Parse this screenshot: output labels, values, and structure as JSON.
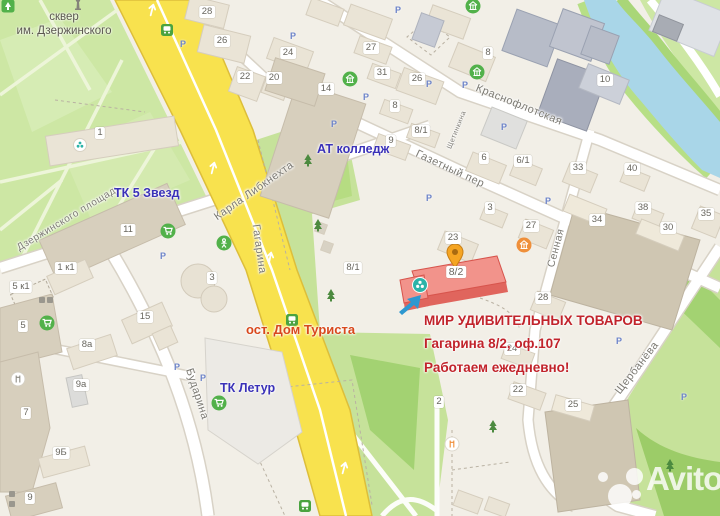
{
  "map_title": "Карта проезда",
  "colors": {
    "road-yellow": "#f8e24e",
    "road-yellow-edge": "#ddbe3a",
    "park-green": "#cde7a4",
    "strip-green": "#c6e29a",
    "dark-green": "#a3d272",
    "river-blue": "#a9d6e8",
    "building-beige": "#eae4d6",
    "building-dark": "#d7cfbd",
    "highlight-red": "#f2938b",
    "highlight-red-side": "#e0655d",
    "label-blue": "#3a31b8",
    "label-red": "#c1232b",
    "label-orange-red": "#d8481c",
    "street-grey": "#7c7a73",
    "poi-green": "#52b14a",
    "pin-orange": "#f5a523",
    "arrow-blue": "#2e98d0",
    "teal": "#2cb3a8"
  },
  "park_label": {
    "line1": "сквер",
    "line2": "им. Дзержинского"
  },
  "annotations": {
    "tk5": "ТК 5 Звезд",
    "at_college": "АТ колледж",
    "tk_letur": "ТК Летур",
    "bus_stop": "ост. Дом Туриста",
    "mir_line1": "МИР УДИВИТЕЛЬНЫХ ТОВАРОВ",
    "mir_line2": "Гагарина 8/2, оф.107",
    "mir_line3": "Работаем ежедневно!"
  },
  "highlight": {
    "number": "8/2"
  },
  "parking_label": "Р",
  "watermark": {
    "text": "Avito"
  },
  "streets": [
    {
      "name": "Дзержинского площадь",
      "x": 69,
      "y": 218,
      "rot": -31,
      "size": 10
    },
    {
      "name": "Карла Либкнехта",
      "x": 254,
      "y": 191,
      "rot": -35,
      "size": 11
    },
    {
      "name": "Гагарина",
      "x": 259,
      "y": 249,
      "rot": 82,
      "size": 11
    },
    {
      "name": "Краснофлотская",
      "x": 519,
      "y": 105,
      "rot": 22,
      "size": 11
    },
    {
      "name": "Газетный пер",
      "x": 450,
      "y": 169,
      "rot": 25,
      "size": 11
    },
    {
      "name": "Щетинкина",
      "x": 457,
      "y": 130,
      "rot": -68,
      "size": 7
    },
    {
      "name": "Сенная",
      "x": 556,
      "y": 248,
      "rot": -75,
      "size": 10.5
    },
    {
      "name": "Щербанёва",
      "x": 637,
      "y": 368,
      "rot": -52,
      "size": 11
    },
    {
      "name": "Бударина",
      "x": 197,
      "y": 394,
      "rot": 72,
      "size": 11
    }
  ],
  "building_numbers": [
    {
      "label": "28",
      "x": 207,
      "y": 12
    },
    {
      "label": "26",
      "x": 222,
      "y": 41
    },
    {
      "label": "24",
      "x": 288,
      "y": 53
    },
    {
      "label": "22",
      "x": 245,
      "y": 77
    },
    {
      "label": "20",
      "x": 274,
      "y": 78
    },
    {
      "label": "14",
      "x": 326,
      "y": 89
    },
    {
      "label": "27",
      "x": 371,
      "y": 48
    },
    {
      "label": "31",
      "x": 382,
      "y": 73
    },
    {
      "label": "26",
      "x": 417,
      "y": 79
    },
    {
      "label": "8",
      "x": 395,
      "y": 106
    },
    {
      "label": "8/1",
      "x": 421,
      "y": 131
    },
    {
      "label": "9",
      "x": 391,
      "y": 141
    },
    {
      "label": "8",
      "x": 488,
      "y": 53
    },
    {
      "label": "10",
      "x": 605,
      "y": 80
    },
    {
      "label": "6",
      "x": 484,
      "y": 158
    },
    {
      "label": "6/1",
      "x": 523,
      "y": 161
    },
    {
      "label": "33",
      "x": 578,
      "y": 168
    },
    {
      "label": "40",
      "x": 632,
      "y": 169
    },
    {
      "label": "38",
      "x": 643,
      "y": 208
    },
    {
      "label": "34",
      "x": 597,
      "y": 220
    },
    {
      "label": "30",
      "x": 668,
      "y": 228
    },
    {
      "label": "35",
      "x": 706,
      "y": 214
    },
    {
      "label": "3",
      "x": 490,
      "y": 208
    },
    {
      "label": "27",
      "x": 531,
      "y": 226
    },
    {
      "label": "23",
      "x": 453,
      "y": 238
    },
    {
      "label": "28",
      "x": 543,
      "y": 298
    },
    {
      "label": "24",
      "x": 512,
      "y": 349
    },
    {
      "label": "22",
      "x": 518,
      "y": 390
    },
    {
      "label": "25",
      "x": 573,
      "y": 405
    },
    {
      "label": "1",
      "x": 100,
      "y": 133
    },
    {
      "label": "11",
      "x": 128,
      "y": 230
    },
    {
      "label": "1 к1",
      "x": 66,
      "y": 268
    },
    {
      "label": "5 к1",
      "x": 21,
      "y": 287
    },
    {
      "label": "5",
      "x": 23,
      "y": 326
    },
    {
      "label": "3",
      "x": 212,
      "y": 278
    },
    {
      "label": "15",
      "x": 145,
      "y": 317
    },
    {
      "label": "8а",
      "x": 87,
      "y": 345
    },
    {
      "label": "9а",
      "x": 81,
      "y": 385
    },
    {
      "label": "7",
      "x": 26,
      "y": 413
    },
    {
      "label": "9Б",
      "x": 61,
      "y": 453
    },
    {
      "label": "9",
      "x": 30,
      "y": 498
    },
    {
      "label": "8/1",
      "x": 353,
      "y": 268
    },
    {
      "label": "2",
      "x": 439,
      "y": 402
    },
    {
      "label": "8/2",
      "x": 456,
      "y": 272
    }
  ],
  "parking_markers": [
    {
      "x": 398,
      "y": 10
    },
    {
      "x": 293,
      "y": 36
    },
    {
      "x": 366,
      "y": 97
    },
    {
      "x": 334,
      "y": 124
    },
    {
      "x": 429,
      "y": 84
    },
    {
      "x": 465,
      "y": 85
    },
    {
      "x": 429,
      "y": 198
    },
    {
      "x": 548,
      "y": 201
    },
    {
      "x": 504,
      "y": 127
    },
    {
      "x": 177,
      "y": 367
    },
    {
      "x": 203,
      "y": 378
    },
    {
      "x": 684,
      "y": 397
    },
    {
      "x": 619,
      "y": 341
    },
    {
      "x": 183,
      "y": 44
    },
    {
      "x": 163,
      "y": 256
    }
  ],
  "pois": [
    {
      "type": "pin",
      "x": 455,
      "y": 256,
      "name": "listing-pin"
    },
    {
      "type": "arrow",
      "x": 412,
      "y": 303,
      "name": "pointer-arrow"
    },
    {
      "type": "swirl",
      "x": 420,
      "y": 285,
      "name": "company-logo-marker"
    },
    {
      "type": "cart",
      "x": 168,
      "y": 231,
      "name": "supermarket"
    },
    {
      "type": "cart",
      "x": 47,
      "y": 323,
      "name": "supermarket"
    },
    {
      "type": "cart",
      "x": 219,
      "y": 403,
      "name": "supermarket"
    },
    {
      "type": "bus",
      "x": 167,
      "y": 30,
      "name": "bus-stop"
    },
    {
      "type": "bus",
      "x": 292,
      "y": 320,
      "name": "bus-stop"
    },
    {
      "type": "bus",
      "x": 305,
      "y": 506,
      "name": "bus-stop"
    },
    {
      "type": "civic",
      "x": 350,
      "y": 79,
      "name": "college"
    },
    {
      "type": "civic",
      "x": 473,
      "y": 6,
      "name": "civic-building"
    },
    {
      "type": "civic",
      "x": 477,
      "y": 72,
      "name": "civic-building"
    },
    {
      "type": "bank",
      "x": 524,
      "y": 245,
      "name": "bank"
    },
    {
      "type": "person",
      "x": 224,
      "y": 243,
      "name": "playground"
    },
    {
      "type": "restaurant",
      "x": 452,
      "y": 444,
      "name": "cafe"
    },
    {
      "type": "restaurantg",
      "x": 18,
      "y": 379,
      "name": "cafe"
    },
    {
      "type": "flower",
      "x": 80,
      "y": 145,
      "name": "park-object"
    },
    {
      "type": "tree",
      "x": 308,
      "y": 160,
      "name": "tree"
    },
    {
      "type": "tree",
      "x": 318,
      "y": 225,
      "name": "tree"
    },
    {
      "type": "tree",
      "x": 331,
      "y": 295,
      "name": "tree"
    },
    {
      "type": "tree",
      "x": 493,
      "y": 426,
      "name": "tree"
    },
    {
      "type": "tree",
      "x": 670,
      "y": 465,
      "name": "tree"
    },
    {
      "type": "monument",
      "x": 78,
      "y": 4,
      "name": "monument"
    },
    {
      "type": "parktag",
      "x": 8,
      "y": 6,
      "name": "park-entrance"
    },
    {
      "type": "roadarrow",
      "x": 213,
      "y": 168,
      "rot": 14,
      "name": "lane-arrow"
    },
    {
      "type": "roadarrow",
      "x": 270,
      "y": 258,
      "rot": 12,
      "name": "lane-arrow"
    },
    {
      "type": "roadarrow",
      "x": 344,
      "y": 468,
      "rot": 15,
      "name": "lane-arrow"
    },
    {
      "type": "roadarrow",
      "x": 152,
      "y": 10,
      "rot": 14,
      "name": "lane-arrow"
    },
    {
      "type": "mini",
      "x": 42,
      "y": 300,
      "name": "small-poi"
    },
    {
      "type": "mini",
      "x": 50,
      "y": 300,
      "name": "small-poi"
    },
    {
      "type": "mini",
      "x": 12,
      "y": 494,
      "name": "small-poi"
    },
    {
      "type": "mini",
      "x": 12,
      "y": 504,
      "name": "small-poi"
    }
  ]
}
